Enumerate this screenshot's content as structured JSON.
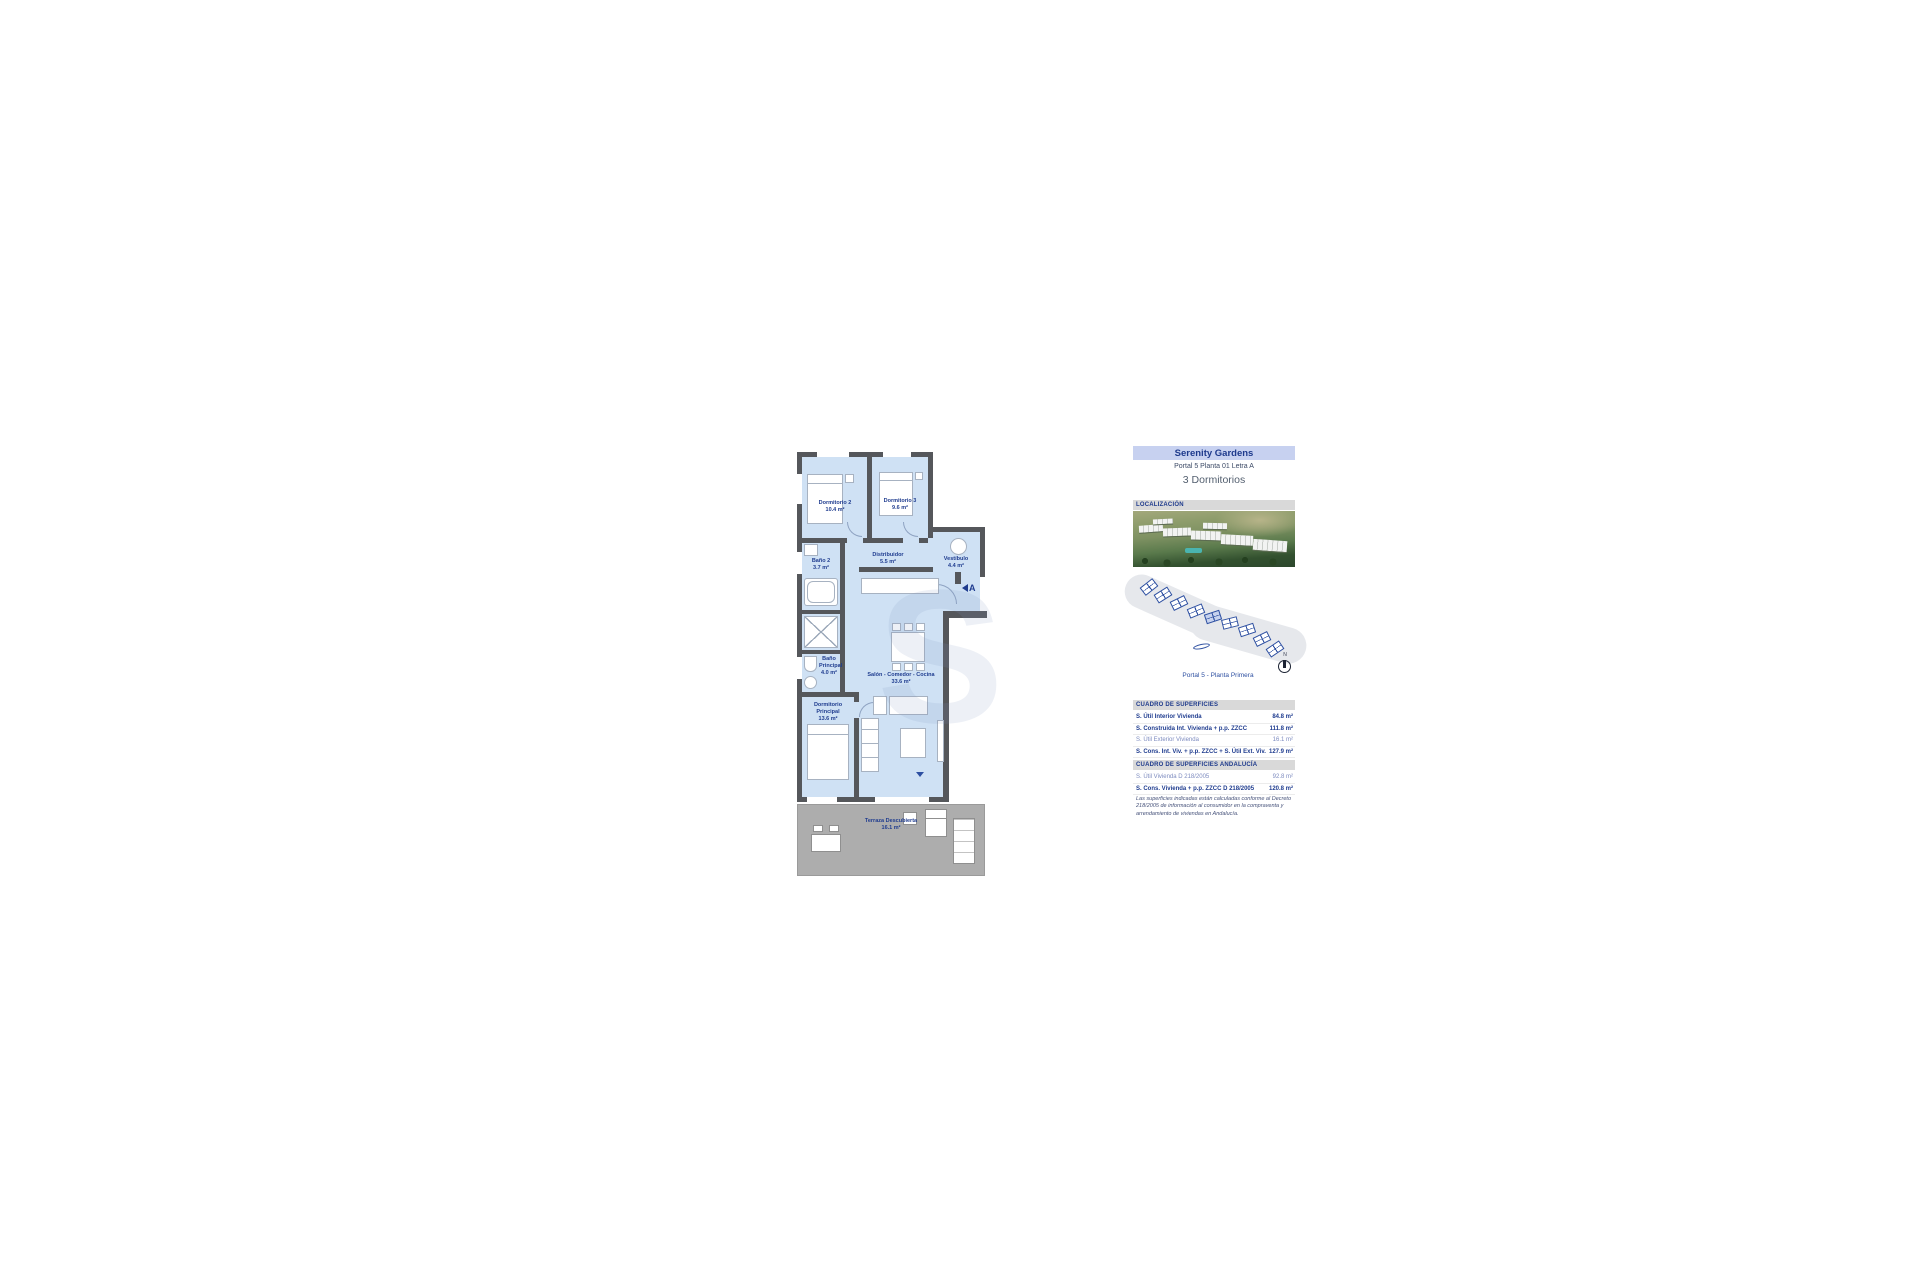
{
  "document": {
    "title": "Serenity Gardens",
    "subtitle": "Portal 5 Planta 01 Letra A",
    "bedrooms_heading": "3 Dormitorios",
    "location_label": "LOCALIZACIÓN",
    "siteplan_caption": "Portal 5 - Planta Primera",
    "compass_label": "N"
  },
  "plan": {
    "entrance_letter": "A",
    "watermark_letter": "S",
    "rooms": {
      "dormitorio2": {
        "name": "Dormitorio 2",
        "area": "10.4 m²"
      },
      "dormitorio3": {
        "name": "Dormitorio 3",
        "area": "9.6 m²"
      },
      "bano2": {
        "name": "Baño 2",
        "area": "3.7 m²"
      },
      "bano_principal": {
        "name": "Baño Principal",
        "area": "4.0 m²"
      },
      "distribuidor": {
        "name": "Distribuidor",
        "area": "5.5 m²"
      },
      "vestibulo": {
        "name": "Vestíbulo",
        "area": "4.4 m²"
      },
      "salon": {
        "name": "Salón - Comedor - Cocina",
        "area": "33.6 m²"
      },
      "dormitorio_principal": {
        "name": "Dormitorio Principal",
        "area": "13.6 m²"
      },
      "terraza": {
        "name": "Terraza Descubierta",
        "area": "16.1 m²"
      }
    }
  },
  "surfaces": {
    "header": "CUADRO DE SUPERFICIES",
    "rows": [
      {
        "label": "S. Útil Interior Vivienda",
        "value": "84.8 m²"
      },
      {
        "label": "S. Construida Int. Vivienda + p.p. ZZCC",
        "value": "111.8 m²"
      },
      {
        "label": "S. Útil Exterior Vivienda",
        "value": "16.1 m²"
      },
      {
        "label": "S. Cons. Int. Viv. + p.p. ZZCC + S. Útil Ext. Viv.",
        "value": "127.9 m²"
      }
    ]
  },
  "surfaces_andalucia": {
    "header": "CUADRO DE SUPERFICIES ANDALUCÍA",
    "rows": [
      {
        "label": "S. Útil Vivienda D 218/2005",
        "value": "92.8 m²"
      },
      {
        "label": "S. Cons. Vivienda + p.p. ZZCC D 218/2005",
        "value": "120.8 m²"
      }
    ]
  },
  "footnote": "Las superficies indicadas están calculadas conforme al Decreto 218/2005 de información al consumidor en la compraventa y arrendamiento de viviendas en Andalucía.",
  "colors": {
    "accent_navy": "#1f3c8f",
    "header_bg": "#c7d1f0",
    "section_bg": "#d9d9d9",
    "room_fill": "#cfe1f4",
    "wall": "#55575b",
    "terrace_fill": "#adadad",
    "siteplan_blue": "#2d4fa1"
  }
}
